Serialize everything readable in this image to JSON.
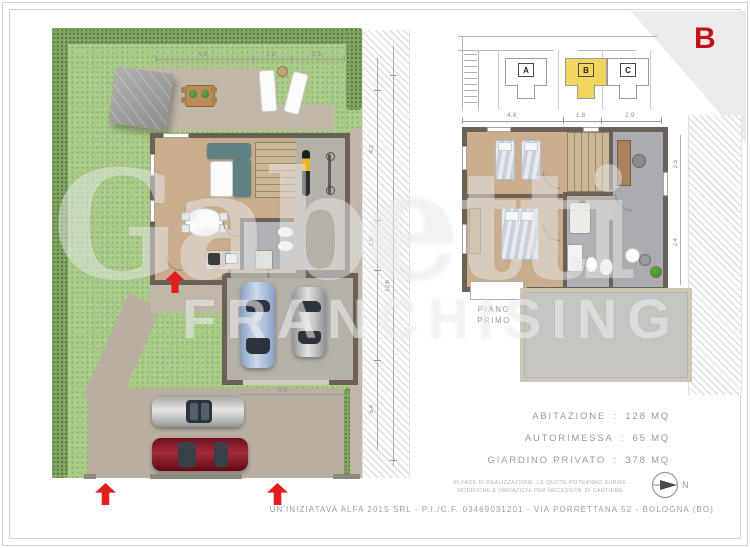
{
  "sheet": {
    "unit_badge": "B",
    "footer_text": "UN'INIZIATAVA ALFA 2015 SRL - P.I./C.F. 03469031201 - VIA PORRETTANA 52 - BOLOGNA (BO)",
    "watermark": {
      "brand": "Gabetti",
      "sub": "FRANCHISING"
    }
  },
  "key_map": {
    "units": [
      {
        "label": "A"
      },
      {
        "label": "B"
      },
      {
        "label": "C"
      }
    ],
    "highlighted_unit": "B",
    "highlight_color": "#f2d55c"
  },
  "ground_floor": {
    "garden_top_dims": [
      "4.6",
      "1.8",
      "2.5"
    ],
    "driveway_dim": "8.5",
    "boundary_dims": [
      "4.2",
      "1.9",
      "5.4",
      "12.6"
    ]
  },
  "first_floor": {
    "label": [
      "PIANO",
      "PRIMO"
    ],
    "top_dims": [
      "4.8",
      "1.8",
      "2.9"
    ],
    "side_dims": [
      "2.5",
      "2.4"
    ]
  },
  "areas": {
    "rows": [
      {
        "label": "ABITAZIONE",
        "sep": ":",
        "value": "128 MQ"
      },
      {
        "label": "AUTORIMESSA",
        "sep": ":",
        "value": "65 MQ"
      },
      {
        "label": "GIARDINO PRIVATO",
        "sep": ":",
        "value": "378 MQ"
      }
    ]
  },
  "disclaimer": {
    "line1": "IN FASE DI REALIZZAZIONE, LE QUOTE POTRANNO SUBIRE",
    "line2": "MODIFICHE E VARIAZIONI PER NECESSITA' DI CANTIERE"
  },
  "compass": {
    "label": "N"
  },
  "colors": {
    "accent_red": "#c41212",
    "arrow_red": "#e01f1f",
    "highlight_yellow": "#f2d55c",
    "text_gray": "#9b9b9b"
  }
}
